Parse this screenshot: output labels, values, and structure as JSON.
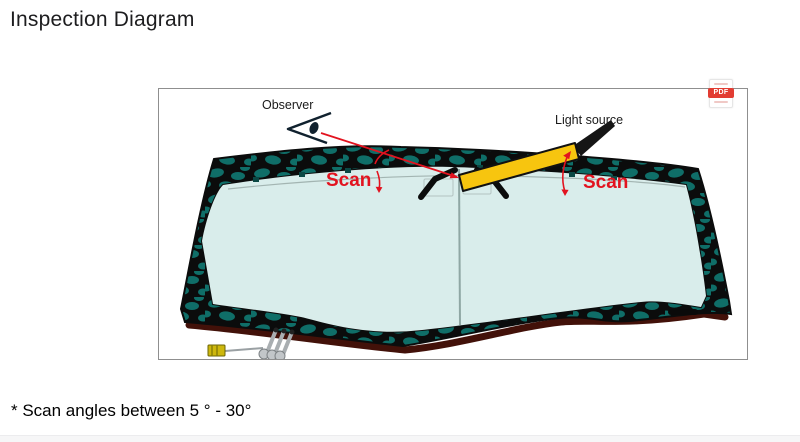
{
  "page": {
    "title": "Inspection Diagram",
    "footnote": "* Scan angles between 5 ° - 30°"
  },
  "diagram": {
    "observer_label": "Observer",
    "light_source_label": "Light source",
    "scan_label_left": "Scan",
    "scan_label_right": "Scan",
    "pdf_badge": "PDF"
  },
  "colors": {
    "title-text": "#1d1d1f",
    "frame-black": "#0b0c0c",
    "frame-teal": "#0f6e68",
    "glass": "#d9edeb",
    "molding-maroon": "#421109",
    "flashlight-yellow": "#f7c50f",
    "annotation-red": "#e2131f",
    "pdf-red": "#e23c32",
    "box-border": "#8f8f8f"
  }
}
